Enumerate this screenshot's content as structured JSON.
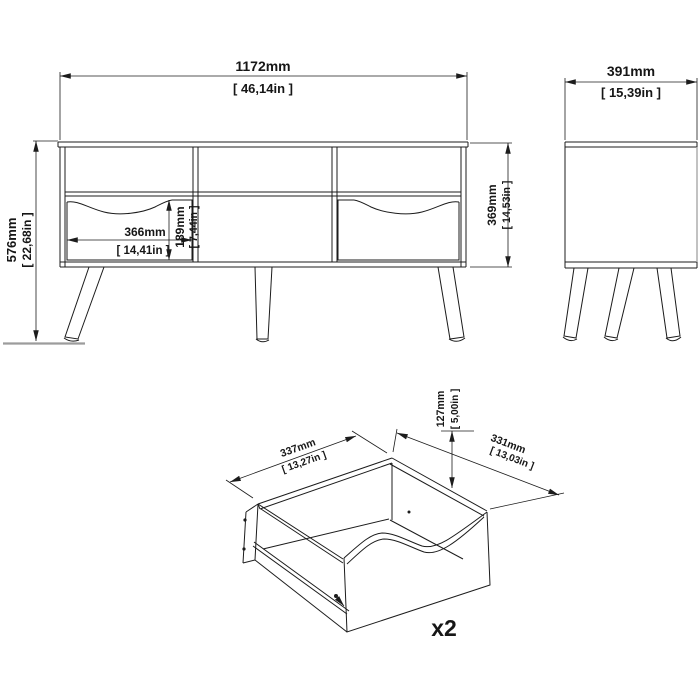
{
  "drawing": {
    "type": "furniture-dimension-diagram",
    "colors": {
      "line": "#1c1c1c",
      "gray_line": "#9c9c9c",
      "background": "#ffffff"
    },
    "front_view": {
      "width_mm": "1172mm",
      "width_in": "[ 46,14in ]",
      "height_mm": "576mm",
      "height_in": "[ 22,68in ]",
      "body_height_mm": "369mm",
      "body_height_in": "[ 14,53in ]",
      "drawer_width_mm": "366mm",
      "drawer_width_in": "[ 14,41in ]",
      "drawer_height_mm": "189mm",
      "drawer_height_in": "[ 7,44in ]"
    },
    "side_view": {
      "depth_mm": "391mm",
      "depth_in": "[ 15,39in ]"
    },
    "drawer_detail": {
      "width_mm": "337mm",
      "width_in": "[ 13,27in ]",
      "height_mm": "127mm",
      "height_in": "[ 5,00in ]",
      "depth_mm": "331mm",
      "depth_in": "[ 13,03in ]",
      "quantity": "x2"
    }
  }
}
